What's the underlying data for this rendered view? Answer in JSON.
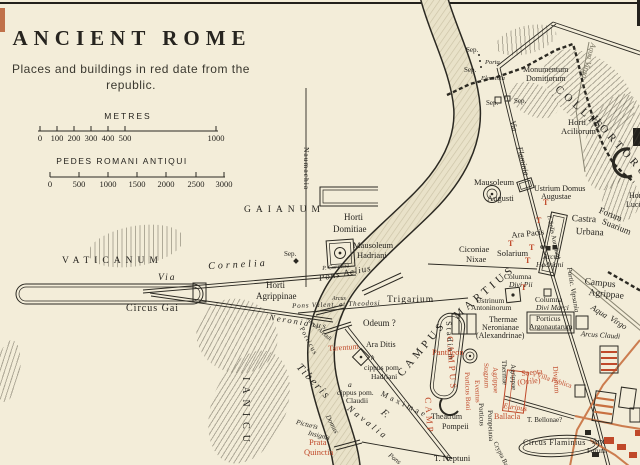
{
  "title": {
    "text": "ANCIENT ROME"
  },
  "subtitle": {
    "line1": "Places and buildings in red date from the",
    "line2": "republic."
  },
  "scales": {
    "metres": {
      "label": "METRES",
      "ticks": [
        "0",
        "100",
        "200",
        "300",
        "400",
        "500",
        "1000"
      ]
    },
    "pedes": {
      "label": "PEDES ROMANI ANTIQUI",
      "ticks": [
        "0",
        "500",
        "1000",
        "1500",
        "2000",
        "2500",
        "3000"
      ]
    }
  },
  "colors": {
    "paper": "#f3edd9",
    "ink": "#26241f",
    "republic_red": "#c0492a",
    "road_orange": "#c87040",
    "river": "#e9e2c9"
  },
  "map": {
    "labels": [
      {
        "t": "VATICANUM",
        "x": 62,
        "y": 257,
        "s": 9.5,
        "sp": 5,
        "n": "label-vaticanum"
      },
      {
        "t": "Via",
        "x": 158,
        "y": 274,
        "s": 9.5,
        "it": 1,
        "sp": 2,
        "n": "label-via-cornelia"
      },
      {
        "t": "Cornelia",
        "x": 208,
        "y": 262,
        "s": 10,
        "it": 1,
        "sp": 3,
        "r": -3
      },
      {
        "t": "Sep.",
        "x": 284,
        "y": 251,
        "s": 7
      },
      {
        "t": "P. Cornelia",
        "x": 322,
        "y": 266,
        "s": 6,
        "it": 1,
        "r": -6,
        "n": "label-porta-cornelia"
      },
      {
        "t": "Circus Gai",
        "x": 126,
        "y": 304,
        "s": 10,
        "sp": 1,
        "n": "label-circus-gai"
      },
      {
        "t": "GAIANUM",
        "x": 244,
        "y": 206,
        "s": 9.5,
        "sp": 5
      },
      {
        "t": "Naumachia",
        "x": 310,
        "y": 147,
        "s": 7.5,
        "r": 90,
        "sp": 1
      },
      {
        "t": "Horti",
        "x": 344,
        "y": 213,
        "s": 9,
        "n": "label-horti-domitiae"
      },
      {
        "t": "Domitiae",
        "x": 333,
        "y": 225,
        "s": 9
      },
      {
        "t": "Mausoleum",
        "x": 353,
        "y": 241,
        "s": 8.5,
        "n": "label-mausoleum-hadriani"
      },
      {
        "t": "Hadriani",
        "x": 357,
        "y": 251,
        "s": 8.5
      },
      {
        "t": "Horti",
        "x": 266,
        "y": 281,
        "s": 9,
        "n": "label-horti-agrippinae"
      },
      {
        "t": "Agrippinae",
        "x": 256,
        "y": 292,
        "s": 9
      },
      {
        "t": "Pons Aelius",
        "x": 318,
        "y": 274,
        "s": 9,
        "it": 1,
        "r": -11,
        "sp": 1
      },
      {
        "t": "Arcus",
        "x": 332,
        "y": 296,
        "s": 6,
        "it": 1
      },
      {
        "t": "Pons Valent. et Theodosi",
        "x": 292,
        "y": 303,
        "s": 7,
        "it": 1,
        "r": -2,
        "sp": 0.8
      },
      {
        "t": "Arcus Arcadi",
        "x": 309,
        "y": 317,
        "s": 6,
        "it": 1,
        "r": 42
      },
      {
        "t": "Neronianus",
        "x": 270,
        "y": 313,
        "s": 8.5,
        "it": 1,
        "sp": 2,
        "r": 9,
        "n": "label-pons-neronianus"
      },
      {
        "t": "Trigarium",
        "x": 387,
        "y": 296,
        "s": 9.5,
        "sp": 1
      },
      {
        "t": "Odeum ?",
        "x": 363,
        "y": 319,
        "s": 9
      },
      {
        "t": "CAMPUS",
        "x": 396,
        "y": 372,
        "s": 11,
        "sp": 4,
        "r": -50,
        "n": "label-campus-martius"
      },
      {
        "t": "MARTIUS",
        "x": 452,
        "y": 313,
        "s": 11,
        "sp": 4,
        "r": -40
      },
      {
        "t": "Stadium",
        "x": 452,
        "y": 321,
        "s": 8,
        "r": 86,
        "sp": 2
      },
      {
        "t": "Tarentum",
        "x": 328,
        "y": 345,
        "s": 8,
        "c": "r",
        "r": -4
      },
      {
        "t": "Ara Ditis",
        "x": 366,
        "y": 341,
        "s": 8
      },
      {
        "t": "h",
        "x": 371,
        "y": 355,
        "s": 7,
        "it": 1
      },
      {
        "t": "cippus pom.",
        "x": 364,
        "y": 364,
        "s": 7.5
      },
      {
        "t": "Hadriani",
        "x": 371,
        "y": 373,
        "s": 7.5
      },
      {
        "t": "a",
        "x": 348,
        "y": 381,
        "s": 7.5,
        "it": 1
      },
      {
        "t": "cippus pom.",
        "x": 337,
        "y": 389,
        "s": 7.5
      },
      {
        "t": "Claudii",
        "x": 346,
        "y": 397,
        "s": 7.5
      },
      {
        "t": "Navalia",
        "x": 351,
        "y": 404,
        "s": 9,
        "sp": 3,
        "r": 38,
        "it": 1
      },
      {
        "t": "Porticus",
        "x": 304,
        "y": 326,
        "s": 7,
        "r": 62,
        "sp": 1
      },
      {
        "t": "Maximae",
        "x": 383,
        "y": 390,
        "s": 8,
        "sp": 3,
        "r": 26
      },
      {
        "t": "Tiberis",
        "x": 302,
        "y": 362,
        "s": 11,
        "it": 1,
        "sp": 2,
        "r": 47,
        "n": "label-tiberis"
      },
      {
        "t": "F.",
        "x": 385,
        "y": 408,
        "s": 10,
        "it": 1,
        "r": 40
      },
      {
        "t": "Domus",
        "x": 330,
        "y": 414,
        "s": 7,
        "it": 1,
        "r": 62
      },
      {
        "t": "Picturis",
        "x": 297,
        "y": 419,
        "s": 7,
        "it": 1,
        "r": 14
      },
      {
        "t": "Insignis",
        "x": 309,
        "y": 430,
        "s": 7,
        "it": 1,
        "r": 14
      },
      {
        "t": "Prata",
        "x": 309,
        "y": 438,
        "s": 8.5,
        "c": "r",
        "n": "label-prata-quinctia"
      },
      {
        "t": "Quinctia",
        "x": 304,
        "y": 448,
        "s": 8.5,
        "c": "r"
      },
      {
        "t": "IANICU",
        "x": 250,
        "y": 377,
        "s": 10,
        "sp": 6,
        "r": 90,
        "n": "label-ianiculum"
      },
      {
        "t": "Pons",
        "x": 391,
        "y": 452,
        "s": 7,
        "it": 1,
        "r": 38
      },
      {
        "t": "T. Neptuni",
        "x": 434,
        "y": 454,
        "s": 8.5
      },
      {
        "t": "Theatrum",
        "x": 431,
        "y": 413,
        "s": 8,
        "n": "label-theatrum-pompeii"
      },
      {
        "t": "Pompeii",
        "x": 442,
        "y": 423,
        "s": 8
      },
      {
        "t": "Porticus",
        "x": 484,
        "y": 403,
        "s": 7,
        "r": 88
      },
      {
        "t": "Pompeiana",
        "x": 493,
        "y": 410,
        "s": 7,
        "r": 88
      },
      {
        "t": "Crypta Balbi",
        "x": 497,
        "y": 441,
        "s": 6.5,
        "r": 64
      },
      {
        "t": "Circus Flaminius",
        "x": 523,
        "y": 439,
        "s": 8,
        "sp": 0.5,
        "n": "label-circus-flaminius"
      },
      {
        "t": "Ballacla",
        "x": 494,
        "y": 413,
        "s": 8,
        "c": "r"
      },
      {
        "t": "T. Bellonae?",
        "x": 527,
        "y": 417,
        "s": 7
      },
      {
        "t": "Saepta",
        "x": 521,
        "y": 370,
        "s": 8,
        "c": "r",
        "r": -6,
        "n": "label-saepta"
      },
      {
        "t": "(Ovile)",
        "x": 517,
        "y": 379,
        "s": 8,
        "c": "r",
        "r": -6
      },
      {
        "t": "Divorum",
        "x": 559,
        "y": 366,
        "s": 7.5,
        "c": "r",
        "r": 86
      },
      {
        "t": "Villa Publica",
        "x": 538,
        "y": 372,
        "s": 7,
        "c": "r",
        "r": 18
      },
      {
        "t": "Euripus",
        "x": 504,
        "y": 402,
        "s": 7.5,
        "c": "r",
        "it": 1,
        "r": 8
      },
      {
        "t": "Porticus Boni",
        "x": 470,
        "y": 372,
        "s": 7,
        "c": "r",
        "r": 88
      },
      {
        "t": "Eventus",
        "x": 480,
        "y": 380,
        "s": 7,
        "c": "r",
        "r": 88
      },
      {
        "t": "Stagnum",
        "x": 489,
        "y": 363,
        "s": 7,
        "c": "r",
        "r": 88
      },
      {
        "t": "Agrippae",
        "x": 498,
        "y": 367,
        "s": 7,
        "c": "r",
        "r": 88
      },
      {
        "t": "Thermae",
        "x": 507,
        "y": 360,
        "s": 7,
        "r": 88
      },
      {
        "t": "Agrippae",
        "x": 516,
        "y": 364,
        "s": 7,
        "r": 88
      },
      {
        "t": "Pantheon",
        "x": 432,
        "y": 348,
        "s": 8.5,
        "c": "r",
        "n": "label-pantheon"
      },
      {
        "t": "Thermae",
        "x": 489,
        "y": 316,
        "s": 8,
        "n": "label-thermae-neronianae"
      },
      {
        "t": "Neronianae",
        "x": 482,
        "y": 324,
        "s": 8
      },
      {
        "t": "(Alexandrinae)",
        "x": 476,
        "y": 332,
        "s": 8
      },
      {
        "t": "Porticus",
        "x": 536,
        "y": 315,
        "s": 7.5,
        "n": "label-porticus-argonautarum"
      },
      {
        "t": "Argonautarum",
        "x": 529,
        "y": 323,
        "s": 7.5
      },
      {
        "t": "Arcus Claudi",
        "x": 581,
        "y": 330,
        "s": 7.5,
        "it": 1,
        "r": 4
      },
      {
        "t": "Campus",
        "x": 585,
        "y": 278,
        "s": 9.5,
        "r": 6,
        "n": "label-campus-agrippae"
      },
      {
        "t": "Agrippae",
        "x": 589,
        "y": 289,
        "s": 9.5,
        "r": 6
      },
      {
        "t": "Portic. Vipsania",
        "x": 572,
        "y": 267,
        "s": 7,
        "it": 1,
        "r": 80
      },
      {
        "t": "Aqua",
        "x": 594,
        "y": 303,
        "s": 8.5,
        "it": 1,
        "r": 32
      },
      {
        "t": "Virgo",
        "x": 613,
        "y": 314,
        "s": 8.5,
        "it": 1,
        "r": 32
      },
      {
        "t": "Columna",
        "x": 504,
        "y": 273,
        "s": 7.5,
        "n": "label-columna-divi-pii"
      },
      {
        "t": "Divi Pii",
        "x": 509,
        "y": 281,
        "s": 7.5,
        "it": 1
      },
      {
        "t": "Columna",
        "x": 535,
        "y": 296,
        "s": 7.5,
        "n": "label-columna-divi-marci"
      },
      {
        "t": "Divi Marci",
        "x": 536,
        "y": 304,
        "s": 7.5,
        "it": 1
      },
      {
        "t": "Ustrinum",
        "x": 476,
        "y": 297,
        "s": 7.5
      },
      {
        "t": "Antoninorum",
        "x": 471,
        "y": 304,
        "s": 7.5
      },
      {
        "t": "Solarium",
        "x": 497,
        "y": 249,
        "s": 8.5
      },
      {
        "t": "Ara Pacis",
        "x": 511,
        "y": 231,
        "s": 8.5,
        "r": -6,
        "n": "label-ara-pacis"
      },
      {
        "t": "Arcus",
        "x": 543,
        "y": 253,
        "s": 7.5,
        "it": 1
      },
      {
        "t": "Hadriani",
        "x": 536,
        "y": 261,
        "s": 7.5,
        "it": 1
      },
      {
        "t": "Ciconiae",
        "x": 459,
        "y": 245,
        "s": 8.5
      },
      {
        "t": "Nixae",
        "x": 466,
        "y": 255,
        "s": 8.5
      },
      {
        "t": "Castra",
        "x": 572,
        "y": 215,
        "s": 9.5,
        "r": 3,
        "n": "label-castra-urbana"
      },
      {
        "t": "Urbana",
        "x": 576,
        "y": 228,
        "s": 9.5,
        "r": 3
      },
      {
        "t": "Forum",
        "x": 601,
        "y": 206,
        "s": 9,
        "r": 22,
        "n": "label-forum-suarium"
      },
      {
        "t": "Suarium",
        "x": 604,
        "y": 217,
        "s": 9,
        "r": 22
      },
      {
        "t": "T. Solis Aureliani",
        "x": 551,
        "y": 214,
        "s": 6.5,
        "r": 78
      },
      {
        "t": "Ustrium Domus",
        "x": 534,
        "y": 185,
        "s": 8
      },
      {
        "t": "Augustae",
        "x": 541,
        "y": 193,
        "s": 8
      },
      {
        "t": "Mausoleum",
        "x": 474,
        "y": 178,
        "s": 8.5,
        "n": "label-mausoleum-augusti"
      },
      {
        "t": "Augusti",
        "x": 487,
        "y": 194,
        "s": 8.5
      },
      {
        "t": "Via",
        "x": 516,
        "y": 120,
        "s": 8,
        "it": 1,
        "r": 76,
        "n": "label-via-flaminia"
      },
      {
        "t": "Flaminia",
        "x": 523,
        "y": 146,
        "s": 8,
        "it": 1,
        "r": 76
      },
      {
        "t": "Sep.",
        "x": 466,
        "y": 47,
        "s": 7
      },
      {
        "t": "Sep.",
        "x": 464,
        "y": 67,
        "s": 7
      },
      {
        "t": "Porta",
        "x": 485,
        "y": 60,
        "s": 6.5,
        "it": 1,
        "n": "label-porta-flaminia"
      },
      {
        "t": "Flaminia",
        "x": 481,
        "y": 76,
        "s": 6.5,
        "it": 1
      },
      {
        "t": "Sep.",
        "x": 486,
        "y": 100,
        "s": 7
      },
      {
        "t": "Sep.",
        "x": 514,
        "y": 98,
        "s": 7
      },
      {
        "t": "Monumentum",
        "x": 523,
        "y": 66,
        "s": 8,
        "n": "label-monumentum-domitiorum"
      },
      {
        "t": "Domitiorum",
        "x": 526,
        "y": 75,
        "s": 8
      },
      {
        "t": "COLLIS",
        "x": 560,
        "y": 84,
        "s": 11,
        "sp": 4,
        "r": 42,
        "n": "label-collis-hortorum"
      },
      {
        "t": "HORTORUM",
        "x": 597,
        "y": 114,
        "s": 11,
        "sp": 4,
        "r": 48
      },
      {
        "t": "Aqua Virgo",
        "x": 597,
        "y": 44,
        "s": 8,
        "it": 1,
        "r": 105,
        "c": "g"
      },
      {
        "t": "Horti",
        "x": 568,
        "y": 118,
        "s": 8.5,
        "n": "label-horti-aciliorum"
      },
      {
        "t": "Aciliorum",
        "x": 561,
        "y": 127,
        "s": 8.5
      },
      {
        "t": "Horti",
        "x": 629,
        "y": 192,
        "s": 8,
        "n": "label-horti-luculliani"
      },
      {
        "t": "Lucul.",
        "x": 626,
        "y": 201,
        "s": 8
      },
      {
        "t": "Arx",
        "x": 592,
        "y": 438,
        "s": 8
      },
      {
        "t": "Forum",
        "x": 587,
        "y": 448,
        "s": 7
      },
      {
        "t": "CAMPUS",
        "x": 454,
        "y": 336,
        "s": 9,
        "sp": 3,
        "c": "r",
        "r": 86
      },
      {
        "t": "CAMP",
        "x": 432,
        "y": 397,
        "s": 9,
        "sp": 3,
        "c": "r",
        "r": 86
      },
      {
        "t": "T",
        "x": 543,
        "y": 199,
        "s": 8,
        "b": 1,
        "c": "r",
        "n": "temple-mark"
      },
      {
        "t": "T",
        "x": 536,
        "y": 217,
        "s": 8,
        "b": 1,
        "c": "r",
        "n": "temple-mark"
      },
      {
        "t": "T",
        "x": 529,
        "y": 244,
        "s": 8,
        "b": 1,
        "c": "r",
        "n": "temple-mark"
      },
      {
        "t": "T",
        "x": 525,
        "y": 257,
        "s": 8,
        "b": 1,
        "c": "r",
        "n": "temple-mark"
      },
      {
        "t": "T",
        "x": 521,
        "y": 284,
        "s": 8,
        "b": 1,
        "c": "r",
        "n": "temple-mark"
      },
      {
        "t": "T",
        "x": 508,
        "y": 240,
        "s": 8,
        "b": 1,
        "c": "r",
        "n": "temple-mark"
      }
    ]
  }
}
